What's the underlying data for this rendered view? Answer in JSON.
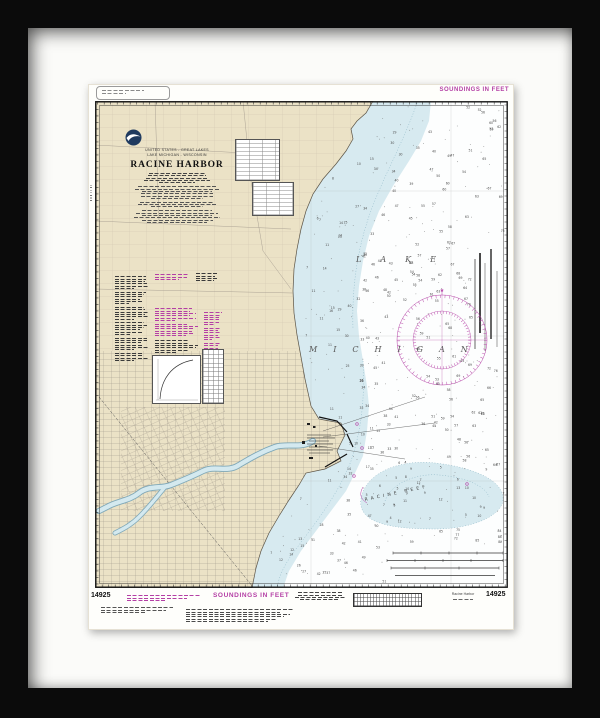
{
  "colors": {
    "magenta": "#b43fa5",
    "land": "#ebe2c6",
    "shallow_water": "#d7eaf0",
    "frame": "#0b0b0b",
    "mat": "#fbfbf9"
  },
  "margins": {
    "top_soundings_note": "SOUNDINGS IN FEET",
    "bottom_soundings_note": "SOUNDINGS IN FEET",
    "chart_number_left": "14925",
    "chart_number_right": "14925",
    "small_title": "Racine Harbor"
  },
  "title_block": {
    "region_line1": "UNITED STATES - GREAT LAKES",
    "region_line2": "LAKE MICHIGAN - WISCONSIN",
    "title": "RACINE HARBOR"
  },
  "water_labels": {
    "lake": "LAKE",
    "michigan": "MICHIGAN",
    "reef": "RACINE REEF"
  }
}
